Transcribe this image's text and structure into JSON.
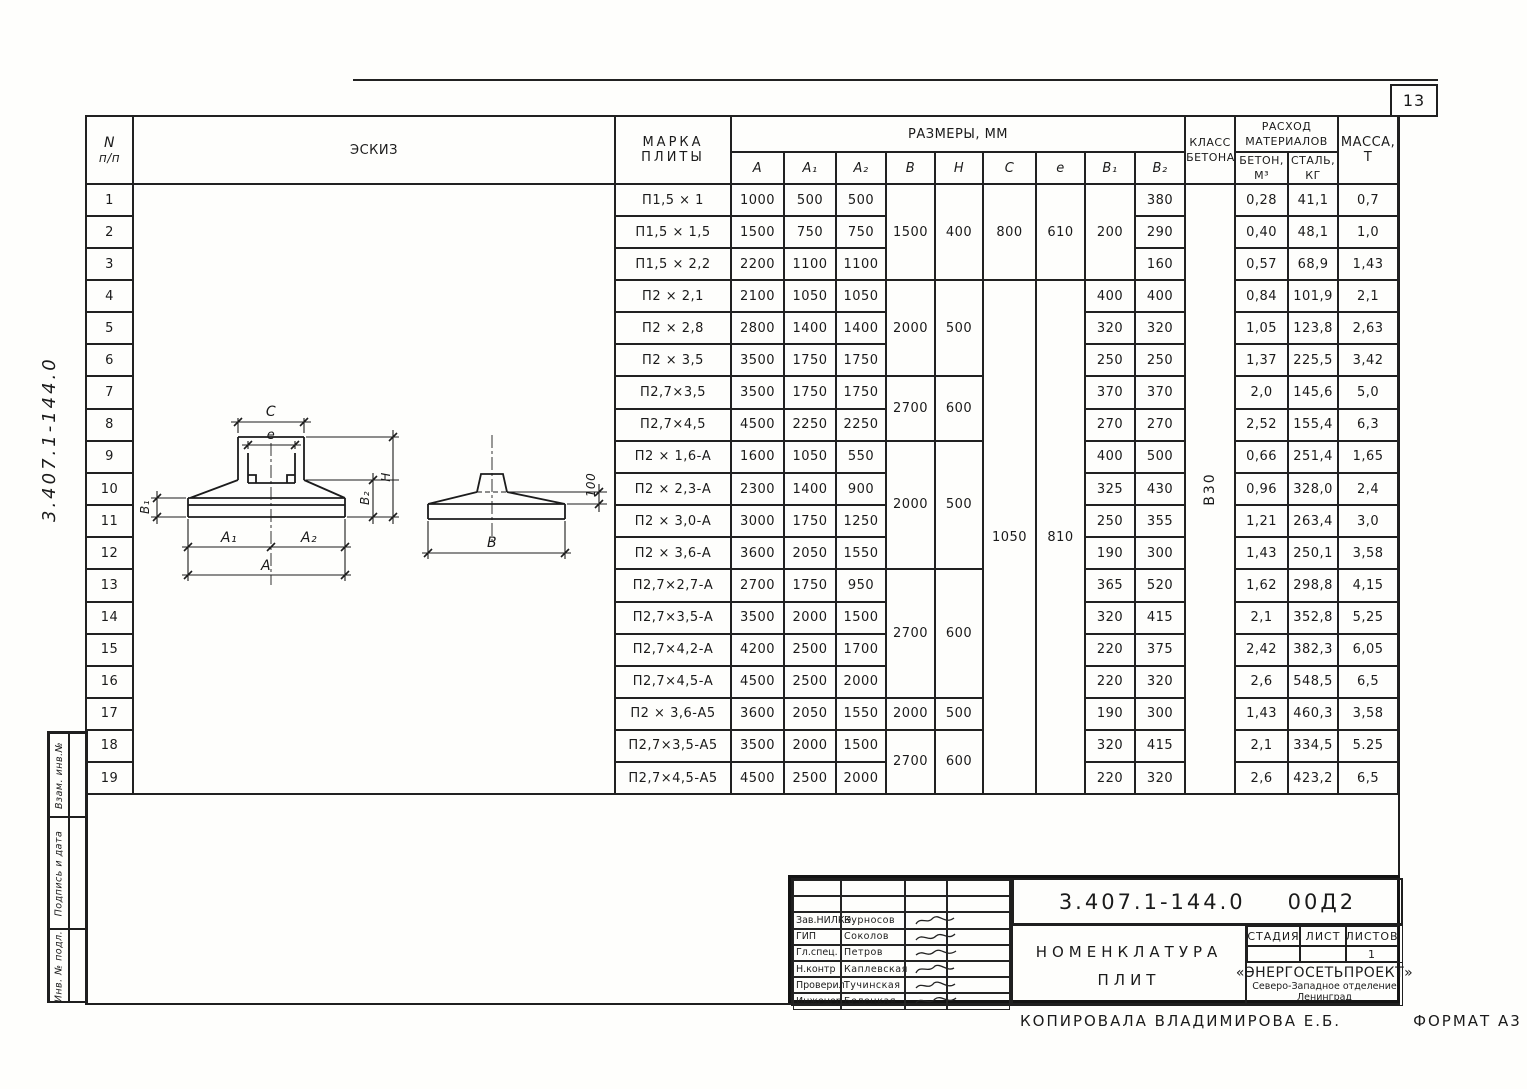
{
  "page_number": "13",
  "margin": {
    "doc_number_handwritten": "3.407.1-144.0",
    "stamp_cells": [
      "Взам. инв.№",
      "Подпись и дата",
      "Инв. № подл."
    ]
  },
  "table": {
    "header": {
      "num": "N",
      "num2": "п/п",
      "sketch": "ЭСКИЗ",
      "mark1": "МАРКА",
      "mark2": "ПЛИТЫ",
      "sizes": "РАЗМЕРЫ, ММ",
      "size_cols": [
        "A",
        "A₁",
        "A₂",
        "B",
        "H",
        "C",
        "e",
        "B₁",
        "B₂"
      ],
      "class1": "КЛАСС",
      "class2": "БЕТОНА",
      "mat1": "РАСХОД",
      "mat2": "МАТЕРИАЛОВ",
      "beton1": "БЕТОН,",
      "beton2": "М³",
      "steel1": "СТАЛЬ,",
      "steel2": "КГ",
      "mass1": "МАССА,",
      "mass2": "Т"
    },
    "concrete_class_value": "В30",
    "rows": [
      {
        "n": "1",
        "mark": "П1,5 × 1",
        "a": "1000",
        "a1": "500",
        "a2": "500",
        "b": {
          "v": "1500",
          "rs": 3
        },
        "h": {
          "v": "400",
          "rs": 3
        },
        "c": {
          "v": "800",
          "rs": 3
        },
        "e": {
          "v": "610",
          "rs": 3
        },
        "b1": {
          "v": "200",
          "rs": 3
        },
        "b2": "380",
        "beton": "0,28",
        "stal": "41,1",
        "massa": "0,7"
      },
      {
        "n": "2",
        "mark": "П1,5 × 1,5",
        "a": "1500",
        "a1": "750",
        "a2": "750",
        "b2": "290",
        "beton": "0,40",
        "stal": "48,1",
        "massa": "1,0"
      },
      {
        "n": "3",
        "mark": "П1,5 × 2,2",
        "a": "2200",
        "a1": "1100",
        "a2": "1100",
        "b2": "160",
        "beton": "0,57",
        "stal": "68,9",
        "massa": "1,43"
      },
      {
        "n": "4",
        "mark": "П2 × 2,1",
        "a": "2100",
        "a1": "1050",
        "a2": "1050",
        "b": {
          "v": "2000",
          "rs": 3
        },
        "h": {
          "v": "500",
          "rs": 3
        },
        "c": {
          "v": "1050",
          "rs": 16
        },
        "e": {
          "v": "810",
          "rs": 16
        },
        "b1": "400",
        "b2": "400",
        "beton": "0,84",
        "stal": "101,9",
        "massa": "2,1"
      },
      {
        "n": "5",
        "mark": "П2 × 2,8",
        "a": "2800",
        "a1": "1400",
        "a2": "1400",
        "b1": "320",
        "b2": "320",
        "beton": "1,05",
        "stal": "123,8",
        "massa": "2,63"
      },
      {
        "n": "6",
        "mark": "П2 × 3,5",
        "a": "3500",
        "a1": "1750",
        "a2": "1750",
        "b1": "250",
        "b2": "250",
        "beton": "1,37",
        "stal": "225,5",
        "massa": "3,42"
      },
      {
        "n": "7",
        "mark": "П2,7×3,5",
        "a": "3500",
        "a1": "1750",
        "a2": "1750",
        "b": {
          "v": "2700",
          "rs": 2
        },
        "h": {
          "v": "600",
          "rs": 2
        },
        "b1": "370",
        "b2": "370",
        "beton": "2,0",
        "stal": "145,6",
        "massa": "5,0"
      },
      {
        "n": "8",
        "mark": "П2,7×4,5",
        "a": "4500",
        "a1": "2250",
        "a2": "2250",
        "b1": "270",
        "b2": "270",
        "beton": "2,52",
        "stal": "155,4",
        "massa": "6,3"
      },
      {
        "n": "9",
        "mark": "П2 × 1,6-А",
        "a": "1600",
        "a1": "1050",
        "a2": "550",
        "b": {
          "v": "2000",
          "rs": 4
        },
        "h": {
          "v": "500",
          "rs": 4
        },
        "b1": "400",
        "b2": "500",
        "beton": "0,66",
        "stal": "251,4",
        "massa": "1,65"
      },
      {
        "n": "10",
        "mark": "П2 × 2,3-А",
        "a": "2300",
        "a1": "1400",
        "a2": "900",
        "b1": "325",
        "b2": "430",
        "beton": "0,96",
        "stal": "328,0",
        "massa": "2,4"
      },
      {
        "n": "11",
        "mark": "П2 × 3,0-А",
        "a": "3000",
        "a1": "1750",
        "a2": "1250",
        "b1": "250",
        "b2": "355",
        "beton": "1,21",
        "stal": "263,4",
        "massa": "3,0"
      },
      {
        "n": "12",
        "mark": "П2 × 3,6-А",
        "a": "3600",
        "a1": "2050",
        "a2": "1550",
        "b1": "190",
        "b2": "300",
        "beton": "1,43",
        "stal": "250,1",
        "massa": "3,58"
      },
      {
        "n": "13",
        "mark": "П2,7×2,7-А",
        "a": "2700",
        "a1": "1750",
        "a2": "950",
        "b": {
          "v": "2700",
          "rs": 4
        },
        "h": {
          "v": "600",
          "rs": 4
        },
        "b1": "365",
        "b2": "520",
        "beton": "1,62",
        "stal": "298,8",
        "massa": "4,15"
      },
      {
        "n": "14",
        "mark": "П2,7×3,5-А",
        "a": "3500",
        "a1": "2000",
        "a2": "1500",
        "b1": "320",
        "b2": "415",
        "beton": "2,1",
        "stal": "352,8",
        "massa": "5,25"
      },
      {
        "n": "15",
        "mark": "П2,7×4,2-А",
        "a": "4200",
        "a1": "2500",
        "a2": "1700",
        "b1": "220",
        "b2": "375",
        "beton": "2,42",
        "stal": "382,3",
        "massa": "6,05"
      },
      {
        "n": "16",
        "mark": "П2,7×4,5-А",
        "a": "4500",
        "a1": "2500",
        "a2": "2000",
        "b1": "220",
        "b2": "320",
        "beton": "2,6",
        "stal": "548,5",
        "massa": "6,5"
      },
      {
        "n": "17",
        "mark": "П2 × 3,6-А5",
        "a": "3600",
        "a1": "2050",
        "a2": "1550",
        "b": "2000",
        "h": "500",
        "b1": "190",
        "b2": "300",
        "beton": "1,43",
        "stal": "460,3",
        "massa": "3,58"
      },
      {
        "n": "18",
        "mark": "П2,7×3,5-А5",
        "a": "3500",
        "a1": "2000",
        "a2": "1500",
        "b": {
          "v": "2700",
          "rs": 2
        },
        "h": {
          "v": "600",
          "rs": 2
        },
        "b1": "320",
        "b2": "415",
        "beton": "2,1",
        "stal": "334,5",
        "massa": "5.25"
      },
      {
        "n": "19",
        "mark": "П2,7×4,5-А5",
        "a": "4500",
        "a1": "2500",
        "a2": "2000",
        "b1": "220",
        "b2": "320",
        "beton": "2,6",
        "stal": "423,2",
        "massa": "6,5"
      }
    ]
  },
  "sketch_labels": {
    "c": "C",
    "e": "e",
    "b1": "B₁",
    "b2": "B₂",
    "h": "H",
    "a1": "A₁",
    "a2": "A₂",
    "a": "A",
    "b": "B",
    "d100": "100"
  },
  "title_block": {
    "doc_number": "3.407.1-144.0",
    "doc_suffix": "00Д2",
    "title_line1": "НОМЕНКЛАТУРА",
    "title_line2": "ПЛИТ",
    "signatures": [
      {
        "role": "Зав.НИЛКЭ",
        "name": "Курносов"
      },
      {
        "role": "ГИП",
        "name": "Соколов"
      },
      {
        "role": "Гл.спец.",
        "name": "Петров"
      },
      {
        "role": "Н.контр",
        "name": "Каплевская"
      },
      {
        "role": "Проверил",
        "name": "Тучинская"
      },
      {
        "role": "Инженер",
        "name": "Белецкая"
      }
    ],
    "stage_label": "СТАДИЯ",
    "sheet_label": "ЛИСТ",
    "sheets_label": "ЛИСТОВ",
    "sheets_value": "1",
    "org_name": "«ЭНЕРГОСЕТЬПРОЕКТ»",
    "org_branch": "Северо-Западное отделение",
    "org_city": "Ленинград"
  },
  "footer": {
    "copied_by": "КОПИРОВАЛА ВЛАДИМИРОВА Е.Б.",
    "format": "ФОРМАТ А3"
  }
}
